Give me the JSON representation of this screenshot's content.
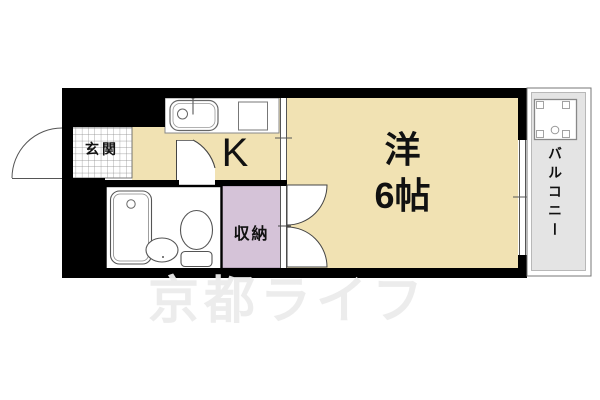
{
  "plan_title": "1K apartment floor plan",
  "rooms": {
    "entrance": {
      "label": "玄関"
    },
    "kitchen": {
      "label": "K"
    },
    "western_room": {
      "label_type": "洋",
      "label_size": "6帖"
    },
    "storage": {
      "label": "収納"
    },
    "balcony": {
      "label": "バルコニー"
    }
  },
  "fixtures": {
    "kitchen_sink": "kitchen-sink-icon",
    "stove": "stove-icon",
    "bathtub": "bathtub-icon",
    "washbasin": "washbasin-icon",
    "toilet": "toilet-icon",
    "washing_machine_pan": "washing-machine-pan-icon",
    "entrance_door": "entrance-door-arc-icon",
    "bathroom_door": "bathroom-door-arc-icon",
    "room_double_door": "double-door-arc-icon"
  },
  "colors": {
    "wall": "#000000",
    "room_floor": "#F1E2B3",
    "storage_fill": "#D5C3D8",
    "balcony_fill": "#E4E4E4",
    "watermark_text": "#ECECEC"
  },
  "watermark": {
    "text": "京都ライフ"
  }
}
